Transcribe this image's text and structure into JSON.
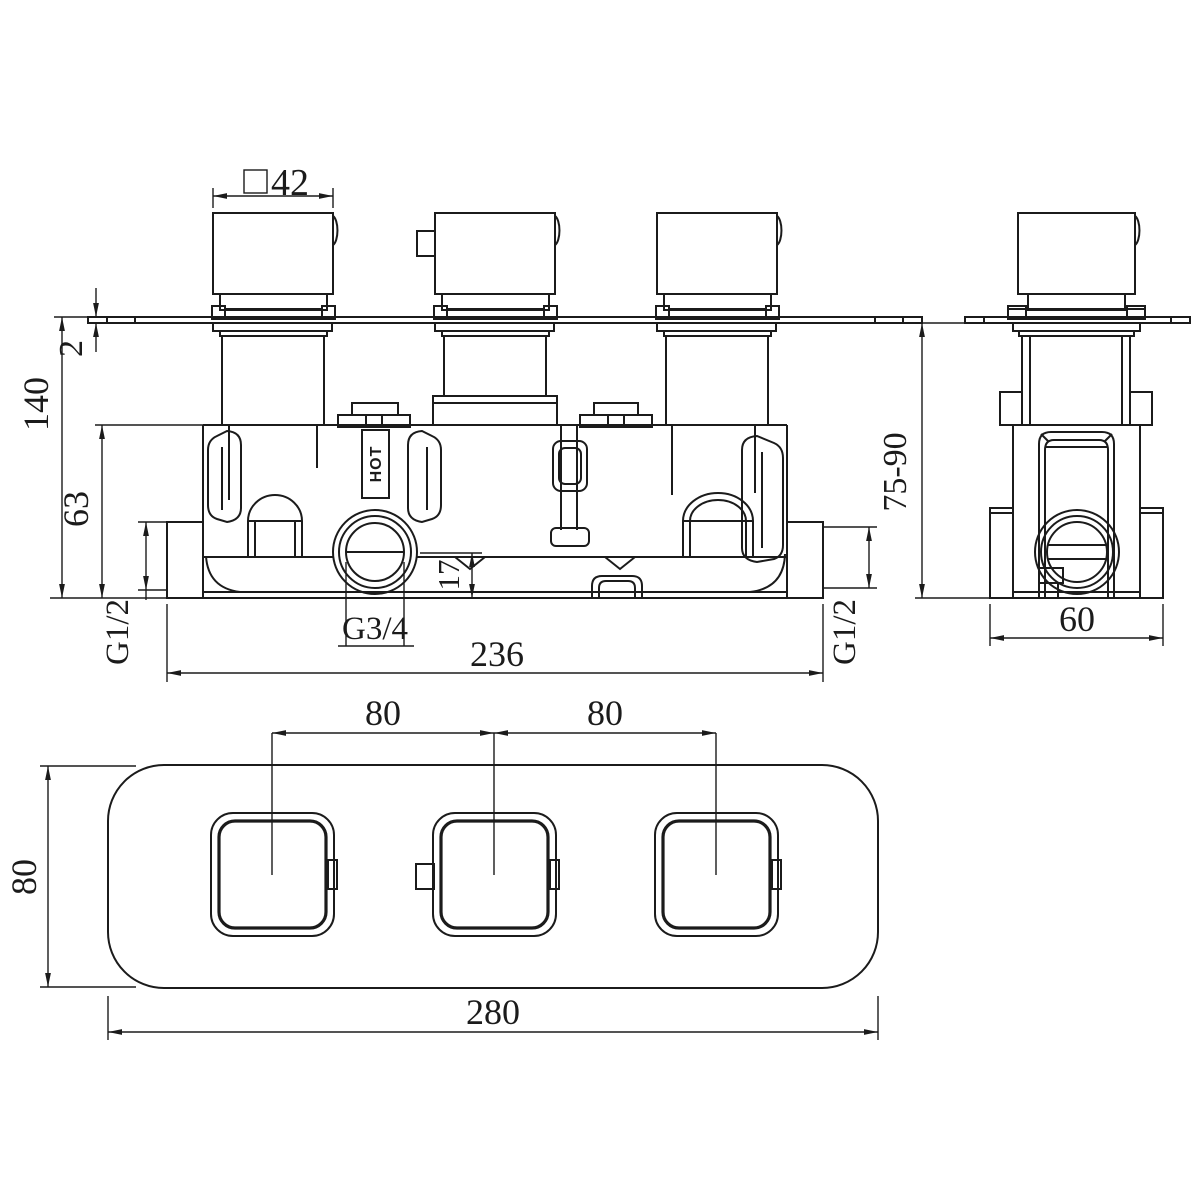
{
  "colors": {
    "background": "#ffffff",
    "line": "#1b1b1b"
  },
  "front": {
    "dim_handle_square": "42",
    "dim_plate_thickness": "2",
    "dim_height_overall": "140",
    "dim_body_height": "63",
    "dim_outlet_to_base": "17",
    "label_outlet_thread": "G3/4",
    "label_inlet_left": "G1/2",
    "label_inlet_right": "G1/2",
    "dim_width_ports": "236",
    "label_hot": "HOT"
  },
  "side": {
    "dim_depth_range": "75-90",
    "dim_body_width": "60"
  },
  "bottom": {
    "dim_spacing_left": "80",
    "dim_spacing_right": "80",
    "dim_plate_height": "80",
    "dim_plate_width": "280"
  }
}
